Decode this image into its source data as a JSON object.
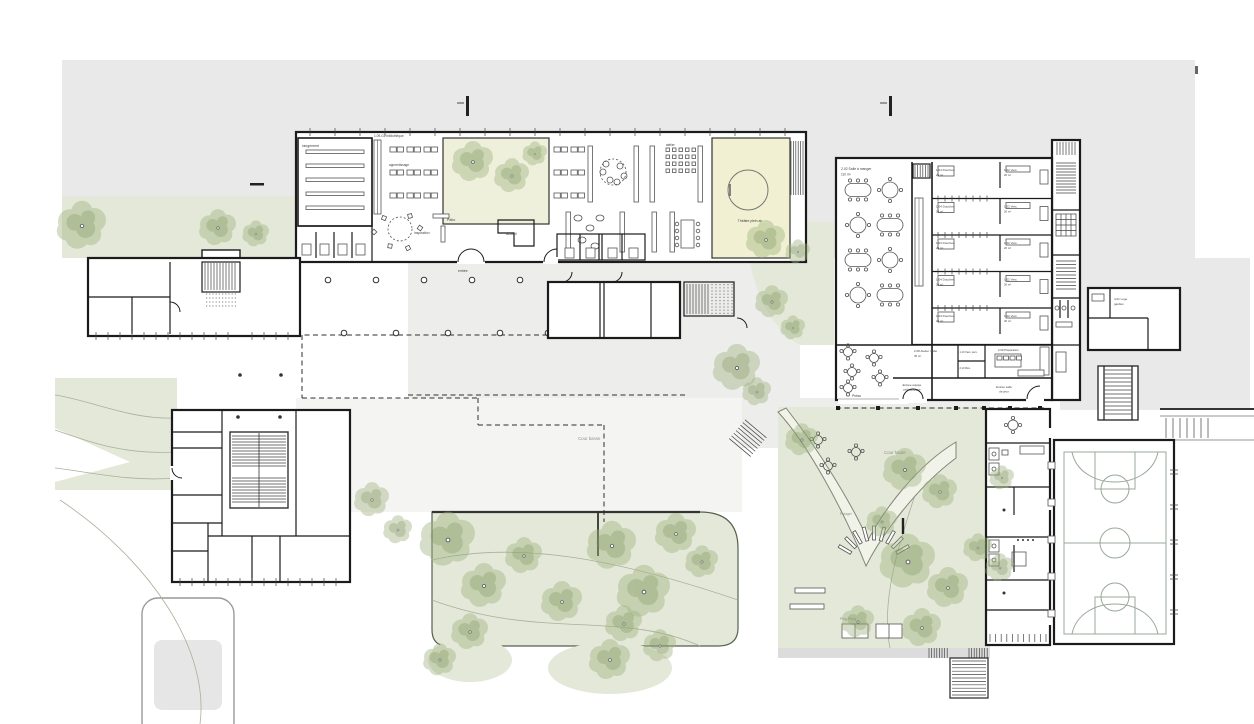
{
  "palette": {
    "page_bg": "#ffffff",
    "context_gray": "#e9e9e9",
    "paving": "#ededec",
    "vegetation": "#e4e8d8",
    "tree": "#9fb37f",
    "patio_yellow": "#f1f0d2",
    "wall": "#1b1b1b",
    "court_lines": "#9aa89b",
    "label_text": "#3f3f3f"
  },
  "labels": {
    "storage": "rangement",
    "library": "1.09-G2 bibliothèque",
    "learning": "apprentissage",
    "patio": "Patio",
    "workshop": "atelier",
    "reception": "accueil",
    "inspiration": "inspiration",
    "entrance": "entrée",
    "theatre": "Théâtre plein air",
    "dining": "2.02 Salle à manger",
    "dining_area": "110 m²",
    "showers": "1.04 Douches",
    "showers_area": "24 m²",
    "lockers": "1.02 Vest.",
    "lockers_area": "26 m²",
    "lab": "2.08 Atelier / labo",
    "lab_area": "45 m²",
    "staff_lockers": "1.10 Vest. pers.",
    "reserve": "2.10 Rés.",
    "prep": "2.09 Préparation",
    "staff_entrance_1": "Entrée équipe",
    "staff_entrance_2": "pédagogique",
    "games_entrance_1": "Entrée salle",
    "games_entrance_2": "de jeux",
    "preau": "Préau",
    "lower_yard": "Cour basse",
    "upper_yard": "Cour haute",
    "garden": "Potager",
    "ping_pong": "Ping-Pong",
    "caretaker_1": "4.01 Loge",
    "caretaker_2": "gardien"
  }
}
